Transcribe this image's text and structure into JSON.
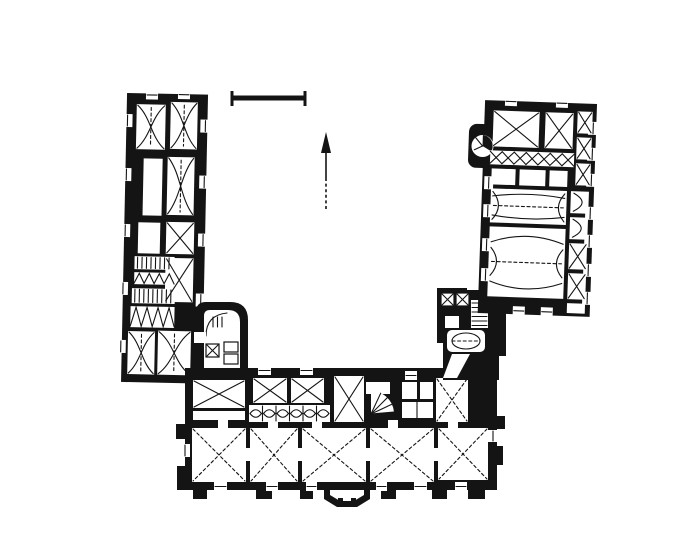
{
  "meta": {
    "description": "Scanned black-and-white architectural ground-floor plan of a U-shaped palace: long left wing, right wing and central south range around an open court; rooms marked with vault diagonals, stairs and window openings; no text labels on the sheet"
  },
  "colors": {
    "paper": "#ffffff",
    "ink": "#141414"
  },
  "symbols": {
    "scale_bar": "graphic scale bar (unlabelled)",
    "north_arrow": "north arrow, lower shaft dashed",
    "vault_x": "crossed diagonals = groin/cross vault",
    "vault_curved": "curved crossing lines = cloister vault",
    "vault_barrel": "arcs with lunettes = barrel vault",
    "stairs": "comb tread lines and fan/spiral stairs",
    "bay_window": "polygonal oriel on south facade"
  }
}
